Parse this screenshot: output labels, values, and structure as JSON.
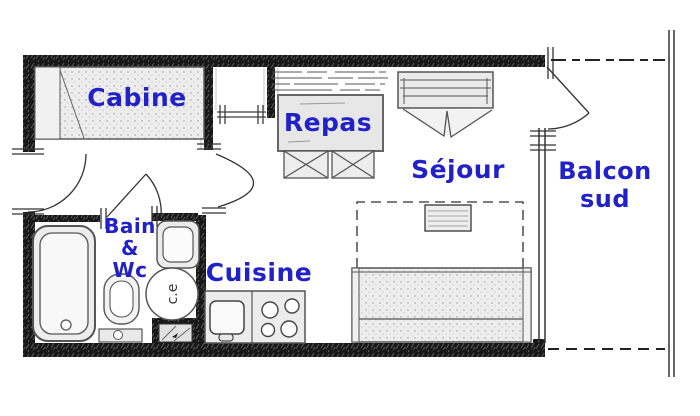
{
  "rooms": {
    "cabine": {
      "label": "Cabine"
    },
    "repas": {
      "label": "Repas"
    },
    "sejour": {
      "label": "Séjour"
    },
    "balcon_sud": {
      "line1": "Balcon",
      "line2": "sud"
    },
    "bain_wc": {
      "line1": "Bain",
      "line2": "&",
      "line3": "Wc"
    },
    "cuisine": {
      "label": "Cuisine"
    }
  },
  "fixtures": {
    "water_heater_label": "c.e"
  },
  "colors": {
    "label_blue": "#2121c8",
    "wall_black": "#181818",
    "room_fill": "#ededed",
    "line_dark": "#4a4a4a"
  }
}
